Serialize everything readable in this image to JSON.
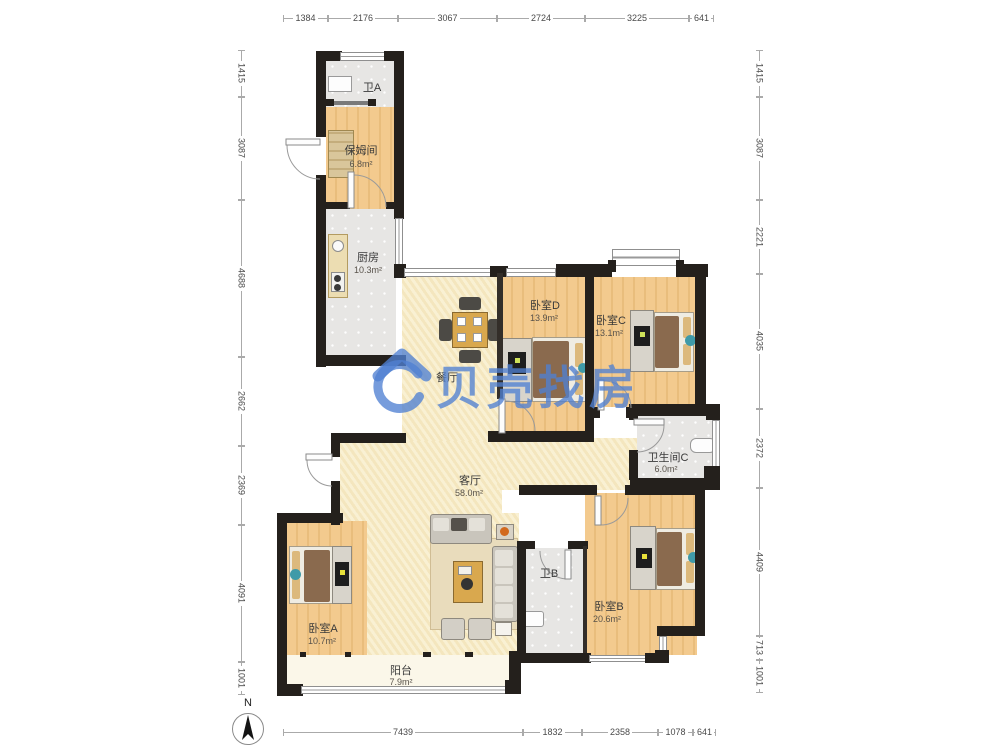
{
  "watermark": {
    "brand": "贝壳找房"
  },
  "compass": {
    "north_label": "N"
  },
  "rooms": {
    "bath_a": {
      "name": "卫A"
    },
    "nanny_room": {
      "name": "保姆间",
      "area": "6.8m²"
    },
    "kitchen": {
      "name": "厨房",
      "area": "10.3m²"
    },
    "dining_room": {
      "name": "餐厅"
    },
    "bedroom_d": {
      "name": "卧室D",
      "area": "13.9m²"
    },
    "bedroom_c": {
      "name": "卧室C",
      "area": "13.1m²"
    },
    "bath_c": {
      "name": "卫生间C",
      "area": "6.0m²"
    },
    "living_room": {
      "name": "客厅",
      "area": "58.0m²"
    },
    "bedroom_a": {
      "name": "卧室A",
      "area": "10.7m²"
    },
    "bath_b": {
      "name": "卫B"
    },
    "bedroom_b": {
      "name": "卧室B",
      "area": "20.6m²"
    },
    "balcony": {
      "name": "阳台",
      "area": "7.9m²"
    }
  },
  "dimensions": {
    "top": [
      "1384",
      "2176",
      "3067",
      "2724",
      "3225",
      "641"
    ],
    "bottom": [
      "7439",
      "1832",
      "2358",
      "1078",
      "641"
    ],
    "left": [
      "1415",
      "3087",
      "4688",
      "2662",
      "2369",
      "4091",
      "1001"
    ],
    "right": [
      "1415",
      "3087",
      "2221",
      "4035",
      "2372",
      "4409",
      "713",
      "1001"
    ]
  },
  "colors": {
    "wall": "#24201c",
    "wood_floor": "#f3ca8e",
    "tile_floor": "#e7e6e4",
    "living_floor": "#f8edc8",
    "watermark_blue": "#4f80d2",
    "accent_teal": "#3f9aa8"
  }
}
